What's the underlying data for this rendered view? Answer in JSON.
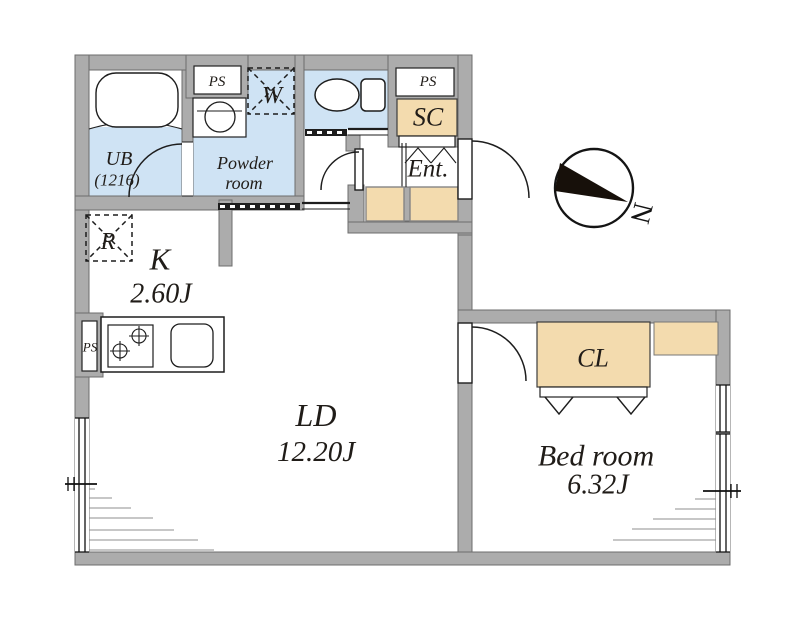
{
  "type": "apartment-floor-plan",
  "colors": {
    "wall": "#acacac",
    "wet_area": "#cfe3f4",
    "storage": "#f3dbae",
    "line": "#1d1d1d"
  },
  "rooms": {
    "unit_bath": {
      "label": "UB",
      "size": "(1216)"
    },
    "powder_room": {
      "label_line1": "Powder",
      "label_line2": "room"
    },
    "kitchen": {
      "label": "K",
      "area": "2.60J"
    },
    "living_dining": {
      "label": "LD",
      "area": "12.20J"
    },
    "bedroom": {
      "label": "Bed room",
      "area": "6.32J"
    },
    "entrance": {
      "label": "Ent."
    },
    "closet": {
      "label": "CL"
    },
    "shoe_closet": {
      "label": "SC"
    }
  },
  "fixtures": {
    "pipe_space_bath": "PS",
    "pipe_space_entrance": "PS",
    "pipe_space_kitchen": "PS",
    "washing_machine": "W",
    "refrigerator": "R"
  },
  "compass": {
    "north": "N"
  }
}
